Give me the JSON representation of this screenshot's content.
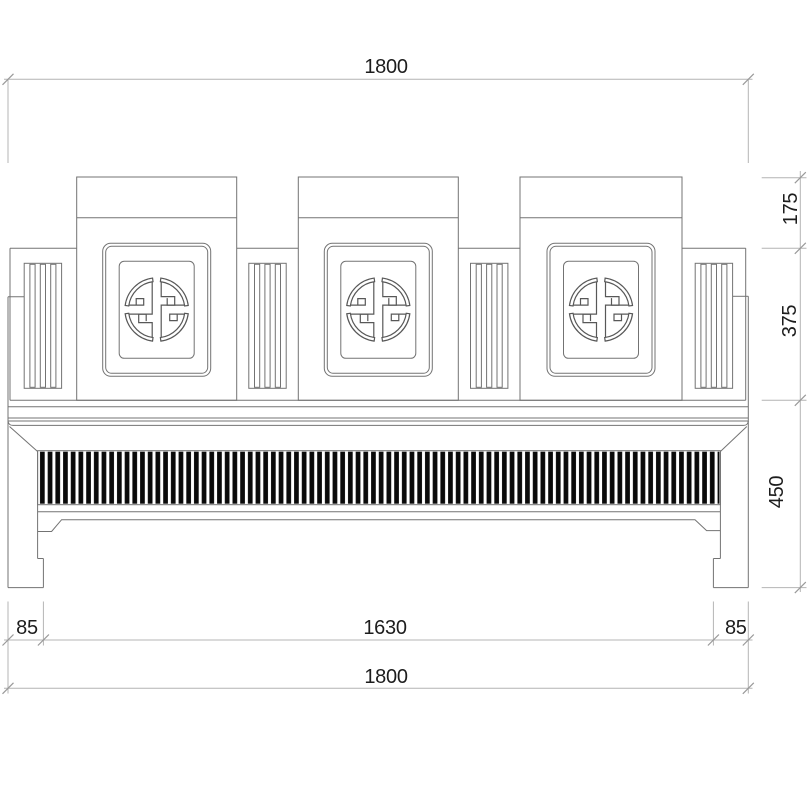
{
  "drawing": {
    "kind": "furniture-front-elevation",
    "dimensions": {
      "top_overall_width": "1800",
      "backrest_top_height": "175",
      "backrest_mid_height": "375",
      "base_height": "450",
      "left_foot_width": "85",
      "inner_span": "1630",
      "right_foot_width": "85",
      "bottom_overall_width": "1800"
    },
    "colors": {
      "background": "#ffffff",
      "object_line": "#737373",
      "medallion_line": "#585858",
      "dimension_line": "#b4b4b4",
      "tick": "#999999",
      "text": "#1d1d1d",
      "slat_fill": "#0a0a0a"
    }
  }
}
